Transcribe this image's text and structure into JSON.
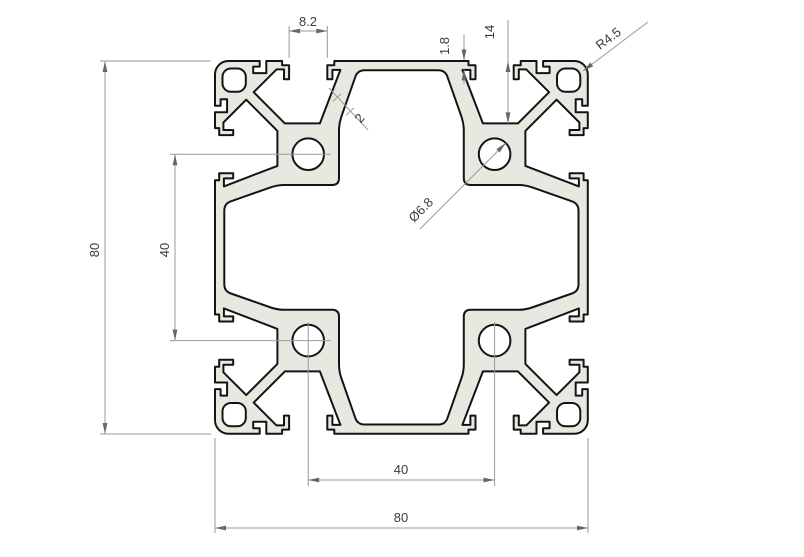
{
  "drawing": {
    "title": "8080 aluminium extrusion profile cross-section",
    "background": "#ffffff"
  },
  "style": {
    "profile_fill": "#e9e8e0",
    "outline_color": "#141414",
    "dim_line_color": "#9a9a9a",
    "arrow_color": "#676767",
    "text_color": "#3c3c3c"
  },
  "annotations": {
    "slot_opening": "8.2",
    "lip_thickness": "1.8",
    "slot_depth": "14",
    "corner_radius": "R4.5",
    "web_thickness": "2",
    "core_hole_diameter": "Ø6.8",
    "overall_height": "80",
    "hole_pitch_vertical": "40",
    "hole_pitch_horizontal": "40",
    "overall_width": "80"
  },
  "profile_geometry": {
    "scale": 4.66,
    "origin": [
      215,
      61
    ],
    "size_mm": 80,
    "outer_corner_radius_mm": 2.9,
    "face_starts": [
      [
        2.9,
        0
      ],
      [
        80,
        2.9
      ],
      [
        77.1,
        80
      ],
      [
        0,
        77.1
      ]
    ],
    "face_pattern": [
      [
        9.6,
        0
      ],
      [
        9.6,
        1.2
      ],
      [
        8.2,
        1.2
      ],
      [
        8.2,
        2.6
      ],
      [
        11.0,
        2.6
      ],
      [
        11.0,
        0
      ],
      [
        14.4,
        0
      ],
      [
        14.4,
        0.9
      ],
      [
        15.9,
        0.9
      ],
      [
        15.9,
        3.9
      ],
      [
        14.8,
        3.9
      ],
      [
        14.8,
        1.8
      ],
      [
        13.2,
        1.8
      ],
      [
        8.3,
        6.7
      ],
      [
        15.0,
        13.4
      ],
      [
        22.5,
        13.4
      ],
      [
        26.9,
        1.9
      ],
      [
        25.2,
        1.9
      ],
      [
        25.2,
        3.9
      ],
      [
        24.1,
        3.9
      ],
      [
        24.1,
        0.9
      ],
      [
        25.6,
        0.9
      ],
      [
        25.6,
        0
      ],
      [
        54.4,
        0
      ],
      [
        54.4,
        0.9
      ],
      [
        55.9,
        0.9
      ],
      [
        55.9,
        3.9
      ],
      [
        54.8,
        3.9
      ],
      [
        54.8,
        1.9
      ],
      [
        53.1,
        1.9
      ],
      [
        57.5,
        13.4
      ],
      [
        65.0,
        13.4
      ],
      [
        71.7,
        6.7
      ],
      [
        66.8,
        1.8
      ],
      [
        65.2,
        1.8
      ],
      [
        65.2,
        3.9
      ],
      [
        64.1,
        3.9
      ],
      [
        64.1,
        0.9
      ],
      [
        65.6,
        0.9
      ],
      [
        65.6,
        0
      ],
      [
        69.0,
        0
      ],
      [
        69.0,
        2.6
      ],
      [
        71.8,
        2.6
      ],
      [
        71.8,
        1.2
      ],
      [
        70.4,
        1.2
      ],
      [
        70.4,
        0
      ],
      [
        77.1,
        0
      ]
    ],
    "plus_points": [
      [
        30.6,
        2
      ],
      [
        49.4,
        2
      ],
      [
        53.4,
        13.4
      ],
      [
        53.4,
        26.6
      ],
      [
        66.6,
        26.6
      ],
      [
        78,
        30.6
      ],
      [
        78,
        49.4
      ],
      [
        66.6,
        53.4
      ],
      [
        53.4,
        53.4
      ],
      [
        53.4,
        66.6
      ],
      [
        49.4,
        78
      ],
      [
        30.6,
        78
      ],
      [
        26.6,
        66.6
      ],
      [
        26.6,
        53.4
      ],
      [
        13.4,
        53.4
      ],
      [
        2,
        49.4
      ],
      [
        2,
        30.6
      ],
      [
        13.4,
        26.6
      ],
      [
        26.6,
        26.6
      ],
      [
        26.6,
        13.4
      ]
    ],
    "corner_square": {
      "size": 5,
      "radius": 1.8,
      "positions": [
        [
          1.6,
          1.6
        ],
        [
          73.4,
          1.6
        ],
        [
          1.6,
          73.4
        ],
        [
          73.4,
          73.4
        ]
      ]
    },
    "core_holes": {
      "radius": 3.4,
      "centers": [
        [
          20,
          20
        ],
        [
          60,
          20
        ],
        [
          20,
          60
        ],
        [
          60,
          60
        ]
      ]
    }
  }
}
